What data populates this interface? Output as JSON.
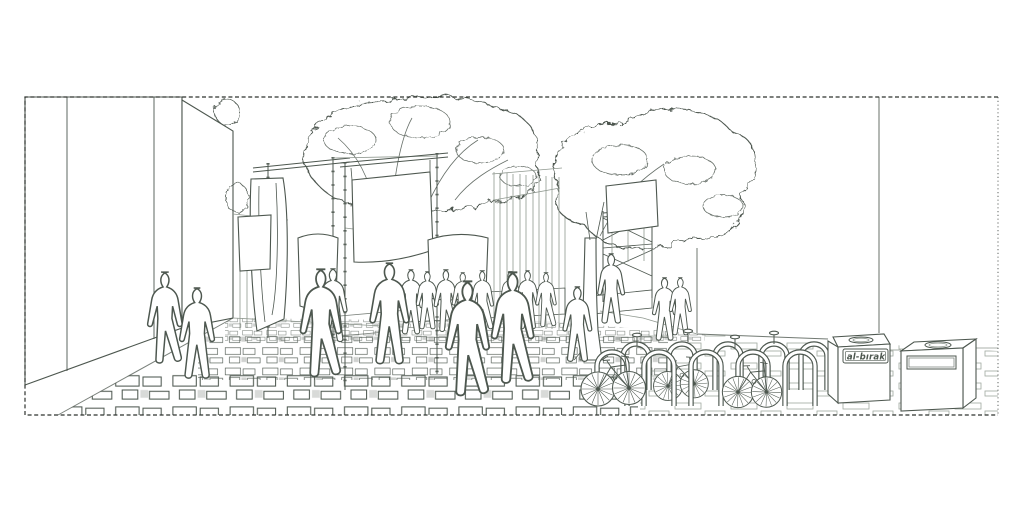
{
  "labels": {
    "box_label": "al-bırak"
  },
  "colors": {
    "ink": "#4d574f",
    "faint": "#8f988f",
    "paper": "#ffffff",
    "border": "#2e332f"
  }
}
